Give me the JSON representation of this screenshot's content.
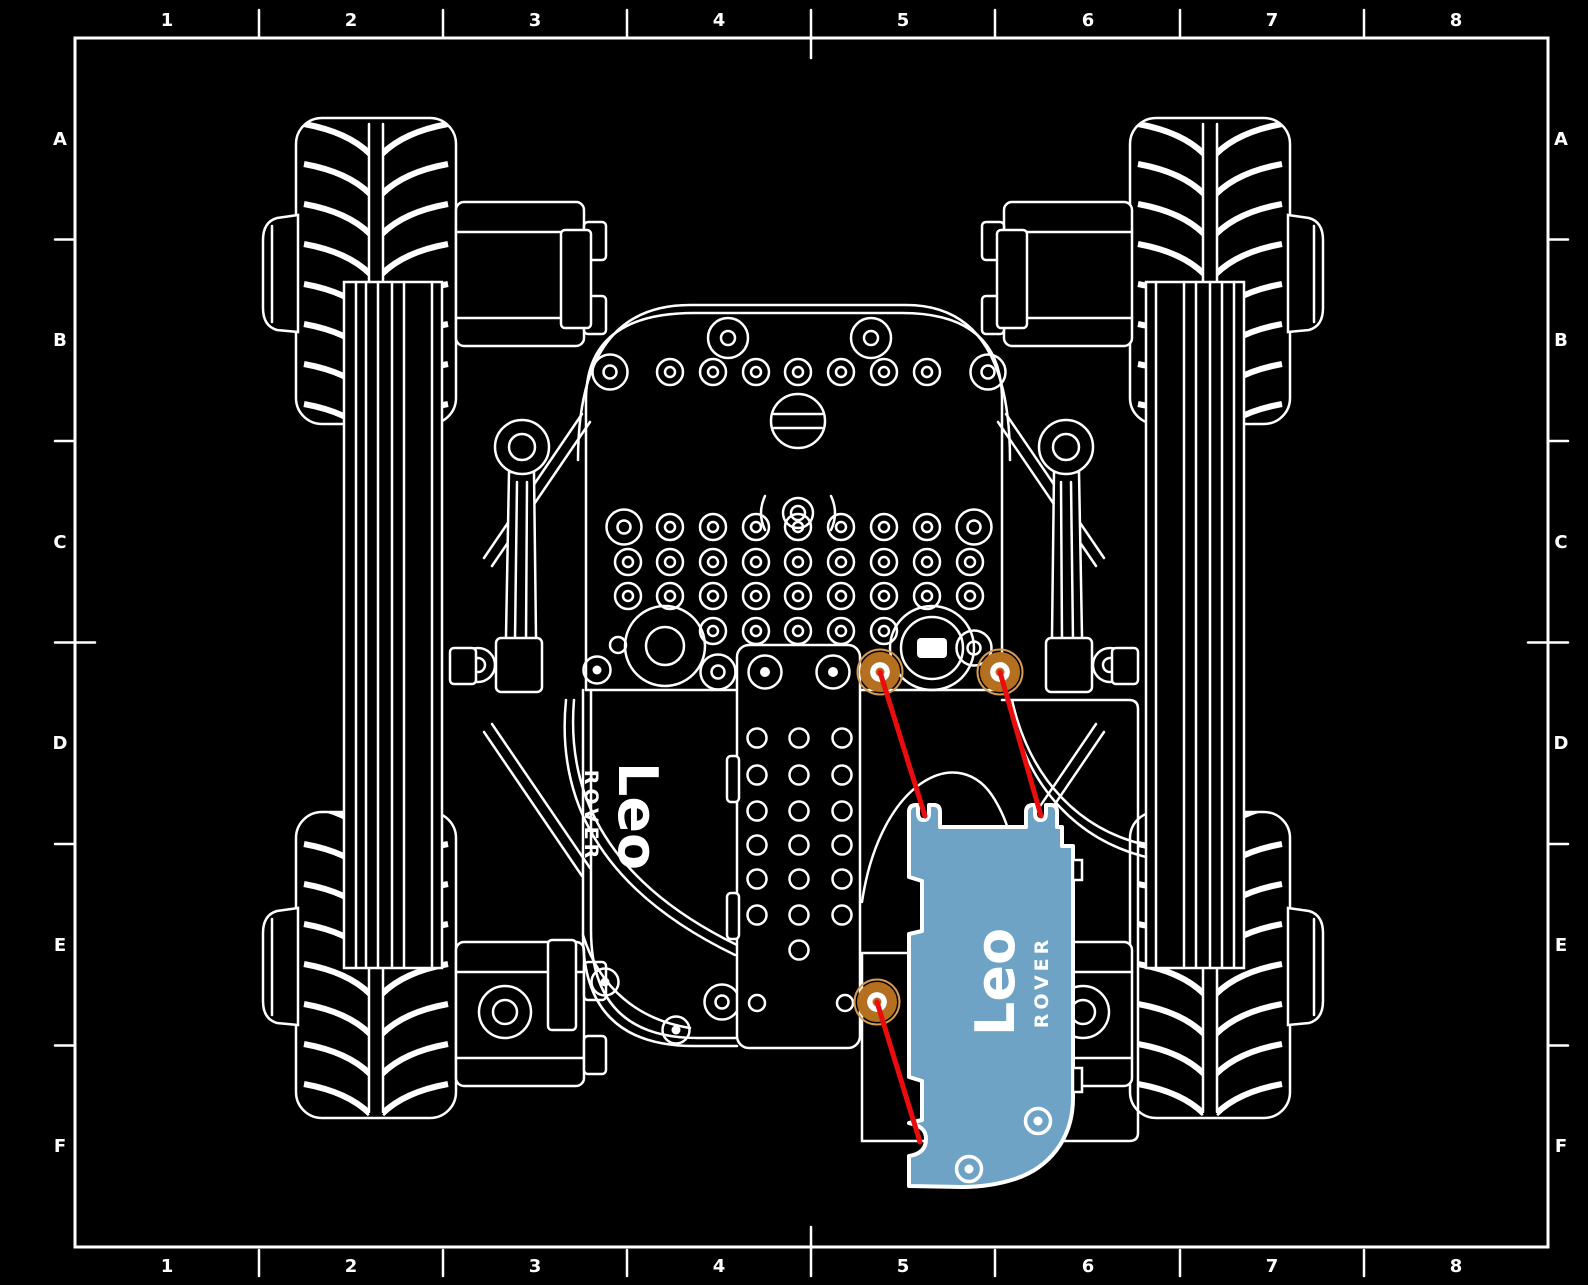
{
  "frame": {
    "grid_columns": [
      "1",
      "2",
      "3",
      "4",
      "5",
      "6",
      "7",
      "8"
    ],
    "grid_rows": [
      "A",
      "B",
      "C",
      "D",
      "E",
      "F"
    ]
  },
  "logos": {
    "body": {
      "name": "Leo",
      "sub": "ROVER"
    },
    "cover": {
      "name": "Leo",
      "sub": "ROVER"
    }
  },
  "colors": {
    "background": "#000000",
    "linework": "#ffffff",
    "highlighted_part": "#6EA3C6",
    "fastener_marker": "#B4701E",
    "fastener_marker_light": "#D89C58",
    "leader_line": "#EB0D0D"
  },
  "annotations": {
    "fasteners": [
      {
        "x": 880,
        "y": 672
      },
      {
        "x": 1000,
        "y": 672
      },
      {
        "x": 877,
        "y": 1002
      }
    ],
    "leaders": [
      {
        "x1": 880,
        "y1": 672,
        "x2": 925,
        "y2": 816
      },
      {
        "x1": 1000,
        "y1": 672,
        "x2": 1041,
        "y2": 816
      },
      {
        "x1": 877,
        "y1": 1002,
        "x2": 920,
        "y2": 1142
      }
    ]
  }
}
